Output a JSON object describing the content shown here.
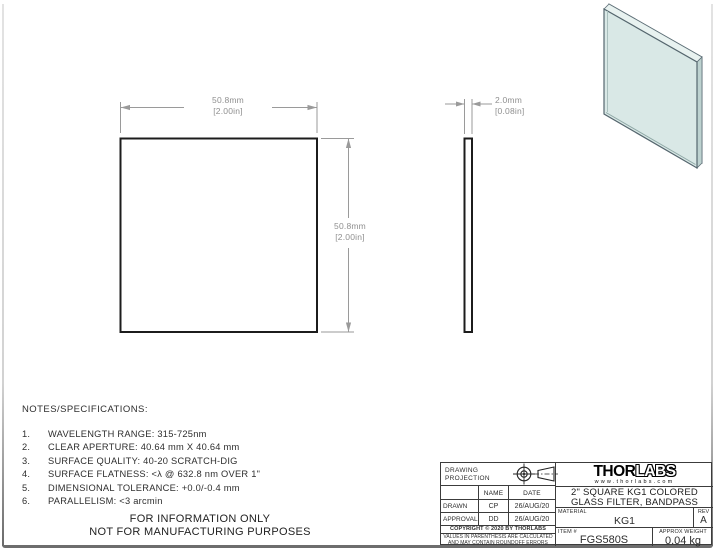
{
  "drawing": {
    "front_view": {
      "width_mm": "50.8mm",
      "width_in": "[2.00in]",
      "height_mm": "50.8mm",
      "height_in": "[2.00in]"
    },
    "side_view": {
      "thickness_mm": "2.0mm",
      "thickness_in": "[0.08in]"
    }
  },
  "notes": {
    "heading": "NOTES/SPECIFICATIONS:",
    "items": [
      {
        "num": "1.",
        "text": "WAVELENGTH RANGE: 315-725nm"
      },
      {
        "num": "2.",
        "text": "CLEAR APERTURE: 40.64 mm X 40.64 mm"
      },
      {
        "num": "3.",
        "text": "SURFACE QUALITY: 40-20 SCRATCH-DIG"
      },
      {
        "num": "4.",
        "text": "SURFACE FLATNESS: <λ @ 632.8 nm OVER 1\""
      },
      {
        "num": "5.",
        "text": "DIMENSIONAL TOLERANCE: +0.0/-0.4 mm"
      },
      {
        "num": "6.",
        "text": "PARALLELISM: <3 arcmin"
      }
    ]
  },
  "info_notice": {
    "line1": "FOR INFORMATION ONLY",
    "line2": "NOT FOR MANUFACTURING PURPOSES"
  },
  "title_block": {
    "projection_label_line1": "DRAWING",
    "projection_label_line2": "PROJECTION",
    "name_header": "NAME",
    "date_header": "DATE",
    "drawn_label": "DRAWN",
    "drawn_name": "CP",
    "drawn_date": "26/AUG/20",
    "approval_label": "APPROVAL",
    "approval_name": "DD",
    "approval_date": "26/AUG/20",
    "copyright": "COPYRIGHT © 2020 BY THORLABS",
    "disclaimer_line1": "VALUES IN PARENTHESIS ARE CALCULATED",
    "disclaimer_line2": "AND MAY CONTAIN ROUNDOFF ERRORS",
    "logo_thor": "THOR",
    "logo_labs": "LABS",
    "logo_url": "www.thorlabs.com",
    "title_line1": "2\" SQUARE KG1 COLORED",
    "title_line2": "GLASS FILTER, BANDPASS",
    "material_label": "MATERIAL",
    "material_value": "KG1",
    "rev_label": "REV",
    "rev_value": "A",
    "item_label": "ITEM #",
    "item_value": "FGS580S",
    "weight_label": "APPROX WEIGHT",
    "weight_value": "0.04 kg"
  },
  "icons": {
    "projection_front": "third-angle-projection-front-icon",
    "projection_cone": "third-angle-projection-side-icon"
  },
  "colors": {
    "glass_face": "#d9e8e6",
    "glass_top": "#e8f2f0",
    "glass_side": "#bdd2d0",
    "drawing_line": "#1c1c1c",
    "dimension": "#8f8f8f"
  }
}
